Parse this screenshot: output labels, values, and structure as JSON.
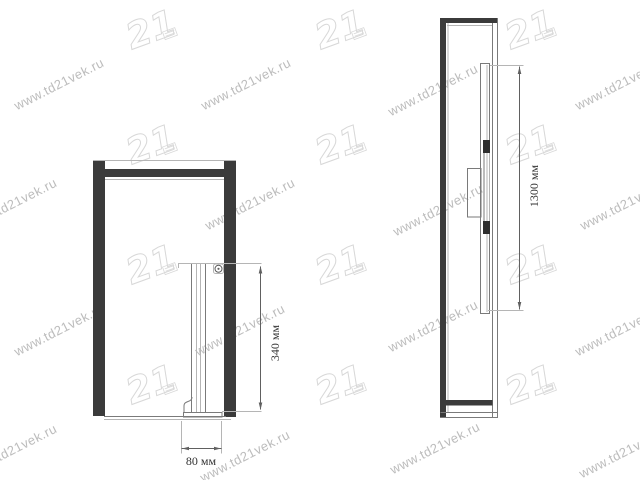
{
  "watermark": {
    "text": "www.td21vek.ru",
    "logo_text": "21",
    "text_color": "#bcbcbc",
    "logo_color": "#d8d8d8",
    "text_positions": [
      [
        59,
        84
      ],
      [
        246,
        84
      ],
      [
        433,
        90
      ],
      [
        620,
        84
      ],
      [
        12,
        204
      ],
      [
        250,
        204
      ],
      [
        438,
        210
      ],
      [
        625,
        204
      ],
      [
        59,
        330
      ],
      [
        240,
        330
      ],
      [
        433,
        326
      ],
      [
        620,
        330
      ],
      [
        12,
        450
      ],
      [
        245,
        456
      ],
      [
        435,
        448
      ],
      [
        624,
        452
      ]
    ],
    "logo_positions": [
      [
        152,
        32
      ],
      [
        341,
        32
      ],
      [
        531,
        32
      ],
      [
        152,
        147
      ],
      [
        341,
        147
      ],
      [
        531,
        147
      ],
      [
        152,
        267
      ],
      [
        341,
        267
      ],
      [
        531,
        267
      ],
      [
        152,
        387
      ],
      [
        341,
        387
      ],
      [
        531,
        387
      ]
    ]
  },
  "drawing": {
    "colors": {
      "dark": "#3b3b3b",
      "line": "#7a7a7a",
      "line_light": "#b5b5b5",
      "dimension": "#606060",
      "label_text": "#333333"
    },
    "views": [
      {
        "id": "front-view"
      },
      {
        "id": "side-view"
      }
    ],
    "dimensions": [
      {
        "id": "rail-height-front",
        "label": "340 мм",
        "orientation": "vertical",
        "view": "front-view"
      },
      {
        "id": "bracket-width-front",
        "label": "80 мм",
        "orientation": "horizontal",
        "view": "front-view"
      },
      {
        "id": "rail-length-side",
        "label": "1300 мм",
        "orientation": "vertical",
        "view": "side-view"
      }
    ]
  }
}
